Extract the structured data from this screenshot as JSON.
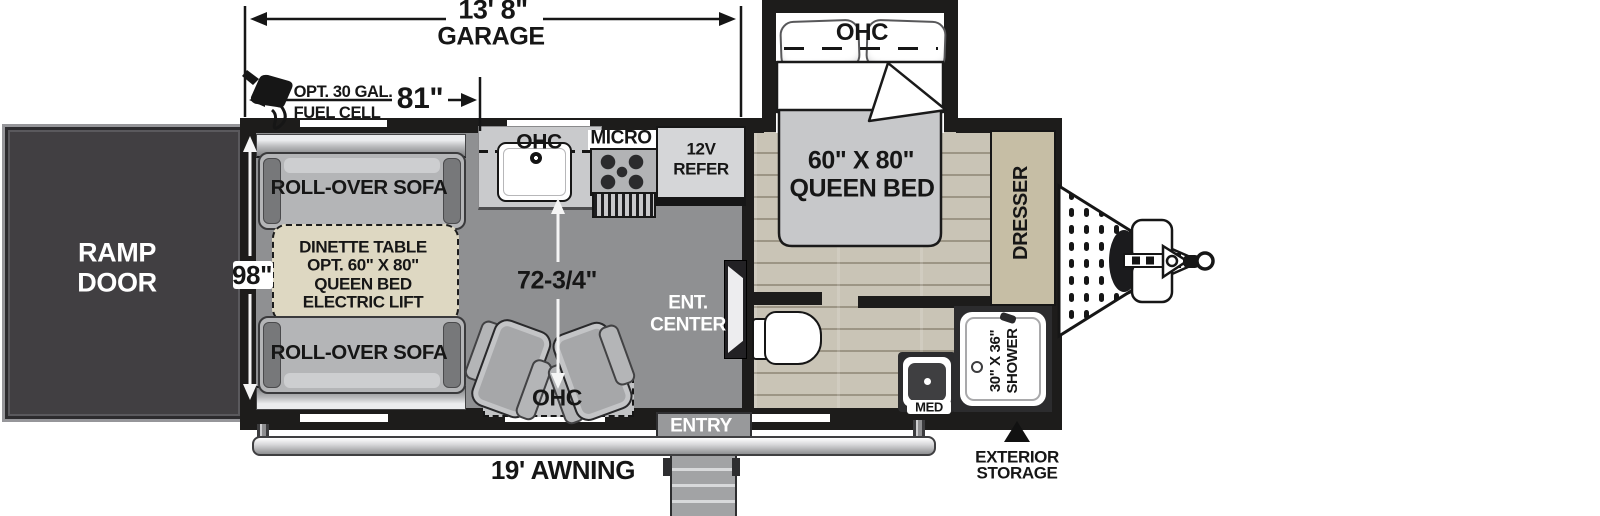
{
  "dims": {
    "garage_length": "13' 8\"",
    "garage_label": "GARAGE",
    "garage_width": "81\"",
    "body_width": "98\"",
    "interior_span": "72-3/4\"",
    "fuel_line1": "OPT. 30 GAL.",
    "fuel_line2": "FUEL CELL"
  },
  "labels": {
    "ramp_line1": "RAMP",
    "ramp_line2": "DOOR",
    "sofa_top": "ROLL-OVER SOFA",
    "sofa_bottom": "ROLL-OVER SOFA",
    "dinette": [
      "DINETTE TABLE",
      "OPT. 60\" X 80\"",
      "QUEEN BED",
      "ELECTRIC LIFT"
    ],
    "kitchen_ohc": "OHC",
    "micro": "MICRO",
    "refer_line1": "12V",
    "refer_line2": "REFER",
    "ent_line1": "ENT.",
    "ent_line2": "CENTER",
    "seats_ohc": "OHC",
    "bed_ohc": "OHC",
    "bed_line1": "60\" X 80\"",
    "bed_line2": "QUEEN BED",
    "dresser": "DRESSER",
    "shower_line1": "30\" X 36\"",
    "shower_line2": "SHOWER",
    "med": "MED",
    "entry": "ENTRY",
    "awning": "19' AWNING",
    "storage_line1": "EXTERIOR",
    "storage_line2": "STORAGE"
  },
  "colors": {
    "wall": "#1d1c1b",
    "garage_floor": "#8f9092",
    "wood_floor": "#c9c4b6",
    "ramp_door": "#413f42",
    "dinette_beige": "#ded8c2",
    "dresser_tan": "#c6bea5",
    "sofa_gray": "#b4b5b7",
    "ink": "#161616"
  }
}
